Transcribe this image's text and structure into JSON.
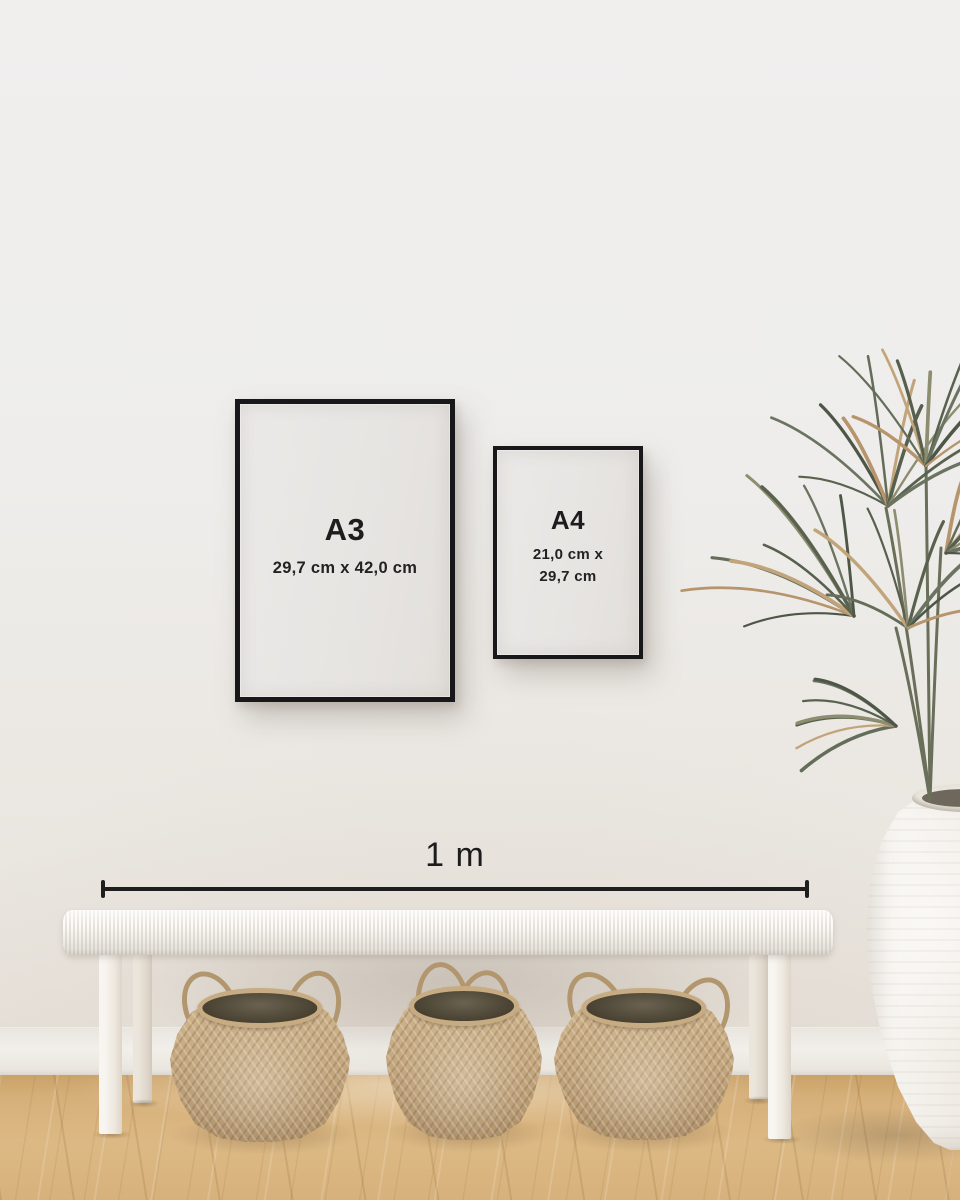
{
  "frames": [
    {
      "label": "A3",
      "size_lines": [
        "29,7 cm x 42,0 cm"
      ]
    },
    {
      "label": "A4",
      "size_lines": [
        "21,0 cm x",
        "29,7 cm"
      ]
    }
  ],
  "scale_bar": {
    "label": "1 m"
  },
  "palette": {
    "frame_black": "#18181b",
    "text_dark": "#1d1d1f",
    "wall_light": "#efeeec",
    "wall_warm": "#e6dfd7",
    "floor_oak": "#d6b07a",
    "basket_tan": "#c4a77e",
    "plant_green": "#59624f",
    "plant_dried": "#b6946c",
    "bench_white": "#f4f1ec",
    "vase_white": "#f1ede7"
  }
}
